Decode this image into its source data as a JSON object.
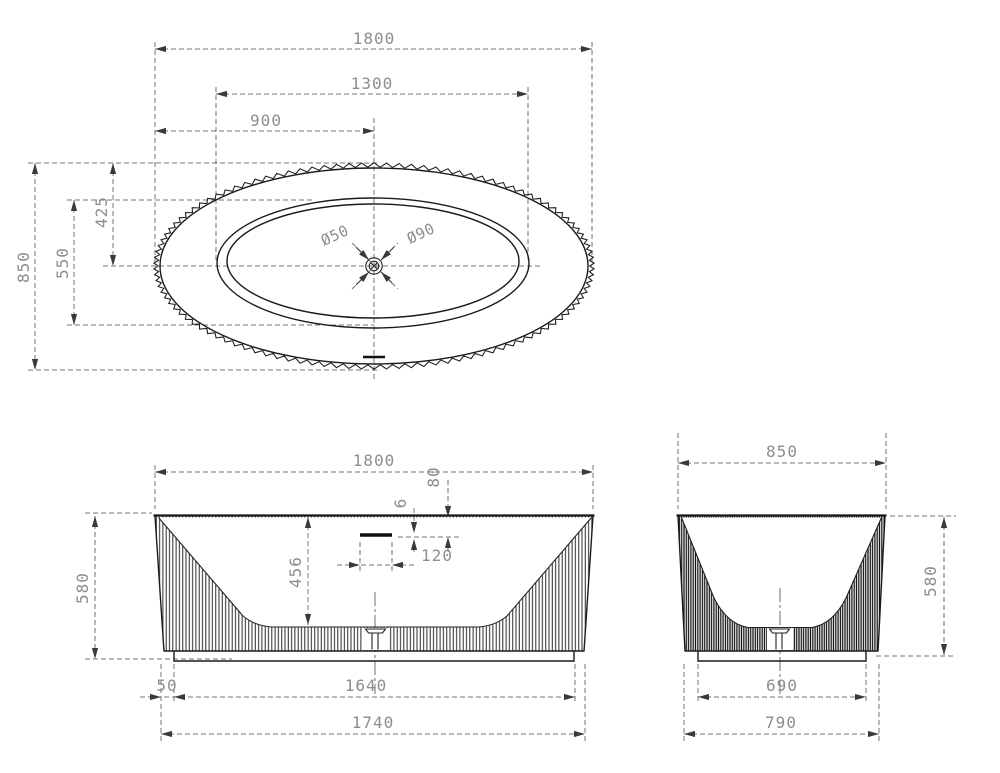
{
  "drawing": {
    "top_view": {
      "length": "1800",
      "basin_length": "1300",
      "drain_offset": "900",
      "width": "850",
      "basin_width": "550",
      "drain_offset_side": "425",
      "drain_diameter": "Ø50",
      "overflow_diameter": "Ø90"
    },
    "front_view": {
      "length": "1800",
      "height": "580",
      "inner_depth": "456",
      "overflow_slot_thickness": "6",
      "overflow_from_rim": "80",
      "overflow_slot_width": "120",
      "base_inset": "50",
      "base_length": "1640",
      "bottom_length": "1740"
    },
    "side_view": {
      "width": "850",
      "height": "580",
      "base_width": "690",
      "bottom_width": "790"
    }
  }
}
